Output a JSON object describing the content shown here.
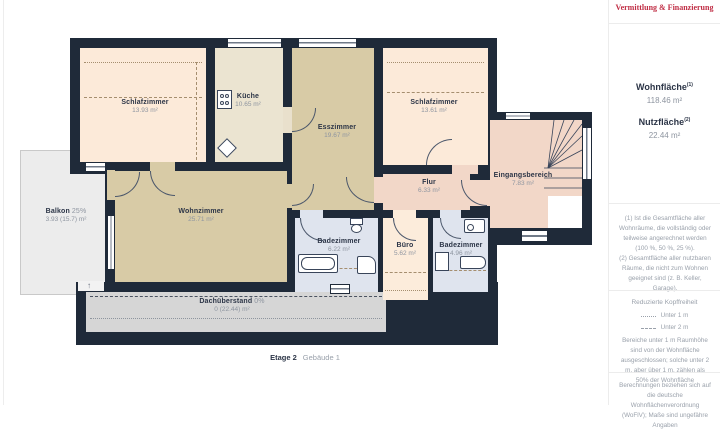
{
  "plan": {
    "rooms": [
      {
        "name": "Schlafzimmer",
        "area": "13.93 m²"
      },
      {
        "name": "Küche",
        "area": "10.65 m²"
      },
      {
        "name": "Esszimmer",
        "area": "19.67 m²"
      },
      {
        "name": "Schlafzimmer",
        "area": "13.61 m²"
      },
      {
        "name": "Flur",
        "area": "6.33 m²"
      },
      {
        "name": "Eingangsbereich",
        "area": "7.83 m²"
      },
      {
        "name": "Wohnzimmer",
        "area": "25.71 m²"
      },
      {
        "name": "Badezimmer",
        "area": "6.22 m²"
      },
      {
        "name": "Büro",
        "area": "5.62 m²"
      },
      {
        "name": "Badezimmer",
        "area": "4.96 m²"
      }
    ],
    "balcony": {
      "name": "Balkon",
      "percent": "25%",
      "area": "3.93 (15.7) m²"
    },
    "roof_overhang": {
      "name": "Dachüberstand",
      "percent": "0%",
      "area": "0 (22.44) m²"
    },
    "floor_label": {
      "floor": "Etage 2",
      "building": "Gebäude 1"
    },
    "icons": {
      "north_arrow_glyph": "↑",
      "fixtures": [
        "stove-icon",
        "sink-icon",
        "bathtub-icon",
        "toilet-icon",
        "shower-icon",
        "stairs-icon"
      ]
    }
  },
  "sidebar": {
    "logo_tagline": "Vermittlung & Finanzierung",
    "summary": {
      "wohnflaeche_label": "Wohnfläche",
      "wohnflaeche_sup": "(1)",
      "wohnflaeche_value": "118.46 m²",
      "nutzflaeche_label": "Nutzfläche",
      "nutzflaeche_sup": "(2)",
      "nutzflaeche_value": "22.44 m²"
    },
    "notes": {
      "note1": "(1) Ist die Gesamtfläche aller Wohnräume, die vollständig oder teilweise angerechnet werden (100 %, 50 %, 25 %).",
      "note2": "(2) Gesamtfläche aller nutzbaren Räume, die nicht zum Wohnen geeignet sind (z. B. Keller, Garage)."
    },
    "legend": {
      "title": "Reduzierte Kopffreiheit",
      "items": [
        {
          "label": "Unter 1 m"
        },
        {
          "label": "Unter 2 m"
        }
      ],
      "description": "Bereiche unter 1 m Raumhöhe sind von der Wohnfläche ausgeschlossen; solche unter 2 m, aber über 1 m, zählen als 50% der Wohnfläche"
    },
    "disclaimer": "Berechnungen beziehen sich auf die deutsche Wohnflächenverordnung (WoFlV); Maße sind ungefähre Angaben"
  },
  "colors": {
    "wall": "#1f2a39",
    "bedroom": "#fcead9",
    "kitchen": "#ebe4d1",
    "living": "#d8cba6",
    "hall": "#f2d7c8",
    "bath": "#dfe4ee",
    "office": "#fcecdb",
    "balcony": "#ececec",
    "roof_strip": "#d6d6d6",
    "tagline_red": "#c02e45",
    "label_dark": "#2c3547",
    "label_gray": "#8e95a0"
  }
}
